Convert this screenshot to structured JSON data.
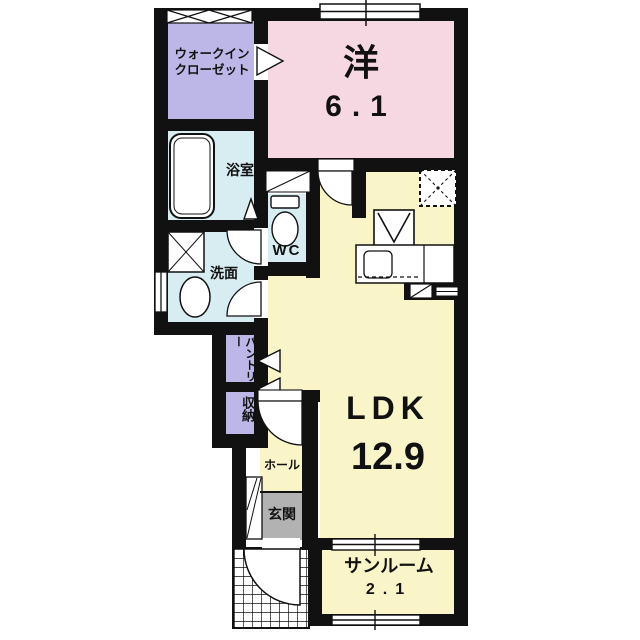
{
  "floorplan": {
    "type": "apartment-floor-plan",
    "rooms": {
      "walk_in_closet": {
        "label_line1": "ウォークイン",
        "label_line2": "クローゼット"
      },
      "western_room": {
        "label": "洋",
        "area": "6.1"
      },
      "bathroom": {
        "label": "浴室"
      },
      "washroom": {
        "label": "洗面"
      },
      "wc": {
        "label": "WC"
      },
      "pantry": {
        "label": "パントリー"
      },
      "storage": {
        "label": "収納"
      },
      "ldk": {
        "label": "LDK",
        "area": "12.9"
      },
      "hall": {
        "label": "ホール"
      },
      "entrance": {
        "label": "玄関"
      },
      "sunroom": {
        "label": "サンルーム",
        "area": "2.1"
      }
    },
    "fixtures": [
      "bathtub-icon",
      "washer-pan-icon",
      "vanity-sink-icon",
      "toilet-icon",
      "stove-icon",
      "kitchen-counter-icon",
      "kitchen-sink-icon",
      "refrigerator-space-icon",
      "pipe-space-icon",
      "shoe-cabinet-icon",
      "door-swing-arc-icon",
      "folding-door-triangle-icon",
      "window-icon",
      "porch-tile-grid-icon",
      "lattice-window-icon"
    ]
  },
  "colors": {
    "wall": "#111111",
    "room_closet": "#bcb7e7",
    "room_western": "#f6d8e2",
    "room_wet": "#d7edf2",
    "room_living": "#faf5c9",
    "room_entrance": "#b2b2b2"
  }
}
